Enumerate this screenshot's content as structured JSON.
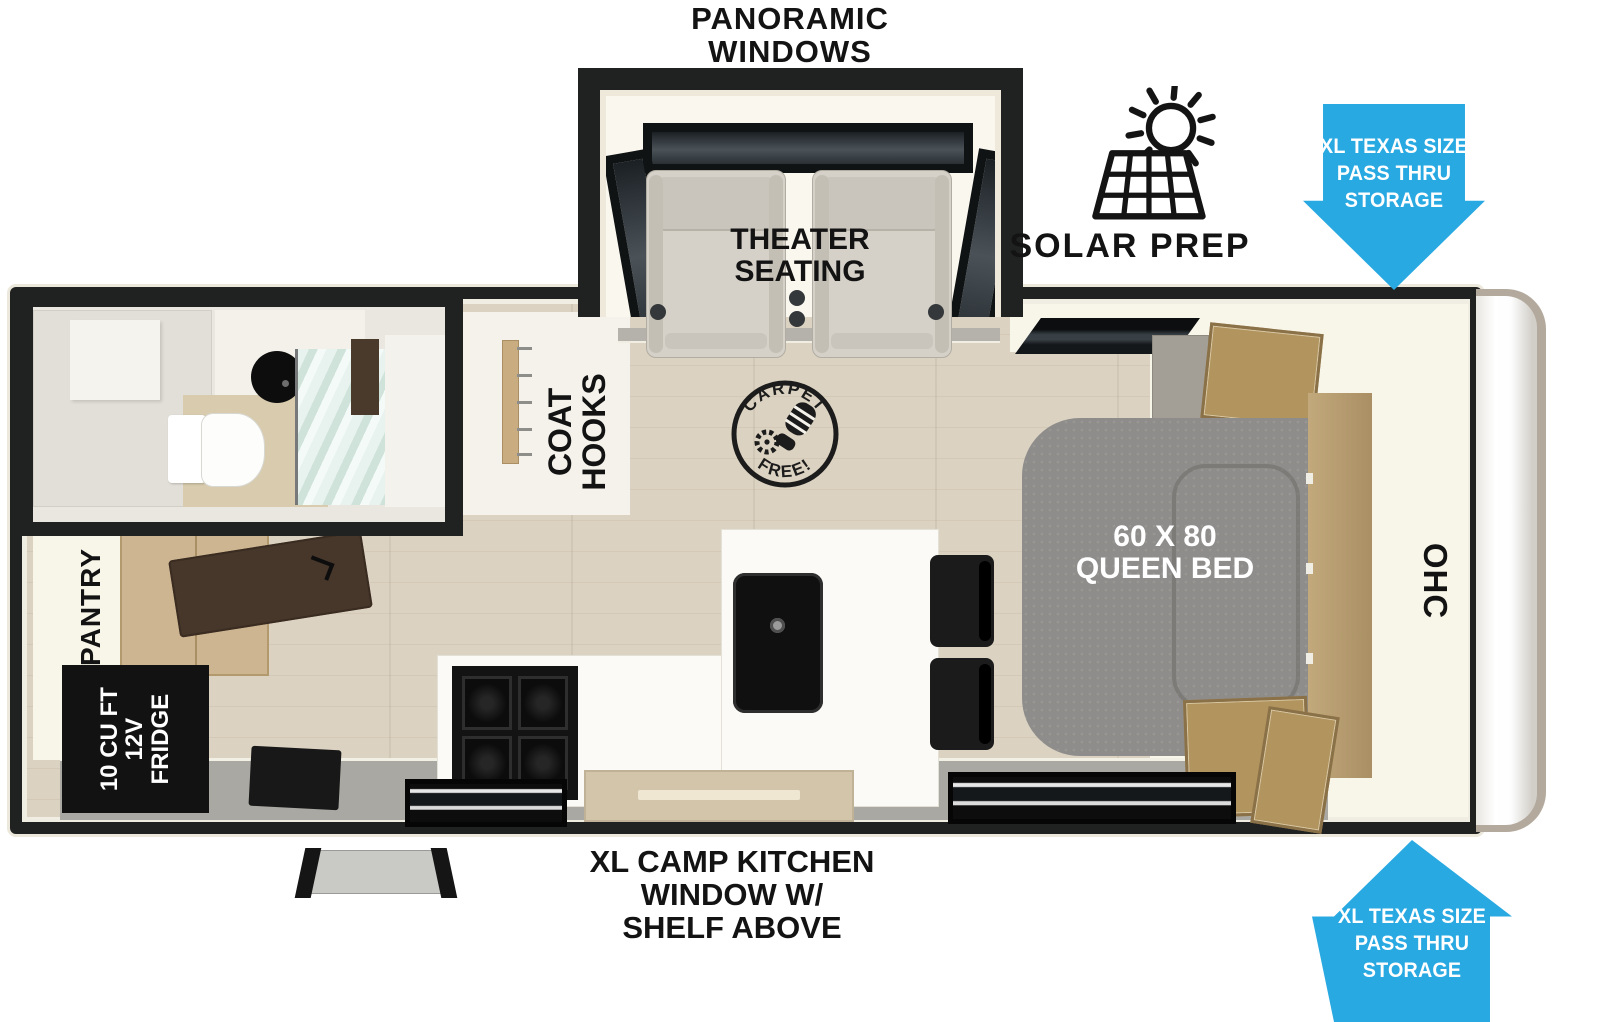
{
  "fp": {
    "title": [
      "PANORAMIC",
      "WINDOWS"
    ],
    "theater": [
      "THEATER",
      "SEATING"
    ],
    "solar": "SOLAR PREP",
    "storage": [
      "XL TEXAS SIZE",
      "PASS THRU",
      "STORAGE"
    ],
    "coat": [
      "COAT",
      "HOOKS"
    ],
    "carpet": {
      "top": "CARPET",
      "bottom": "FREE!"
    },
    "bed": [
      "60 X 80",
      "QUEEN BED"
    ],
    "ohc": "OHC",
    "pantry": "PANTRY",
    "fridge": [
      "10 CU FT",
      "12V",
      "FRIDGE"
    ],
    "camp": [
      "XL CAMP KITCHEN",
      "WINDOW W/",
      "SHELF ABOVE"
    ],
    "colors": {
      "arrow_blue": "#29a9e2",
      "wall": "#202222",
      "floor": "#d9d0c0",
      "cream": "#f8f5e9",
      "bed_gray": "#8e8d8b",
      "wood": "#b89f73",
      "glass": "#d7e8e2"
    }
  }
}
